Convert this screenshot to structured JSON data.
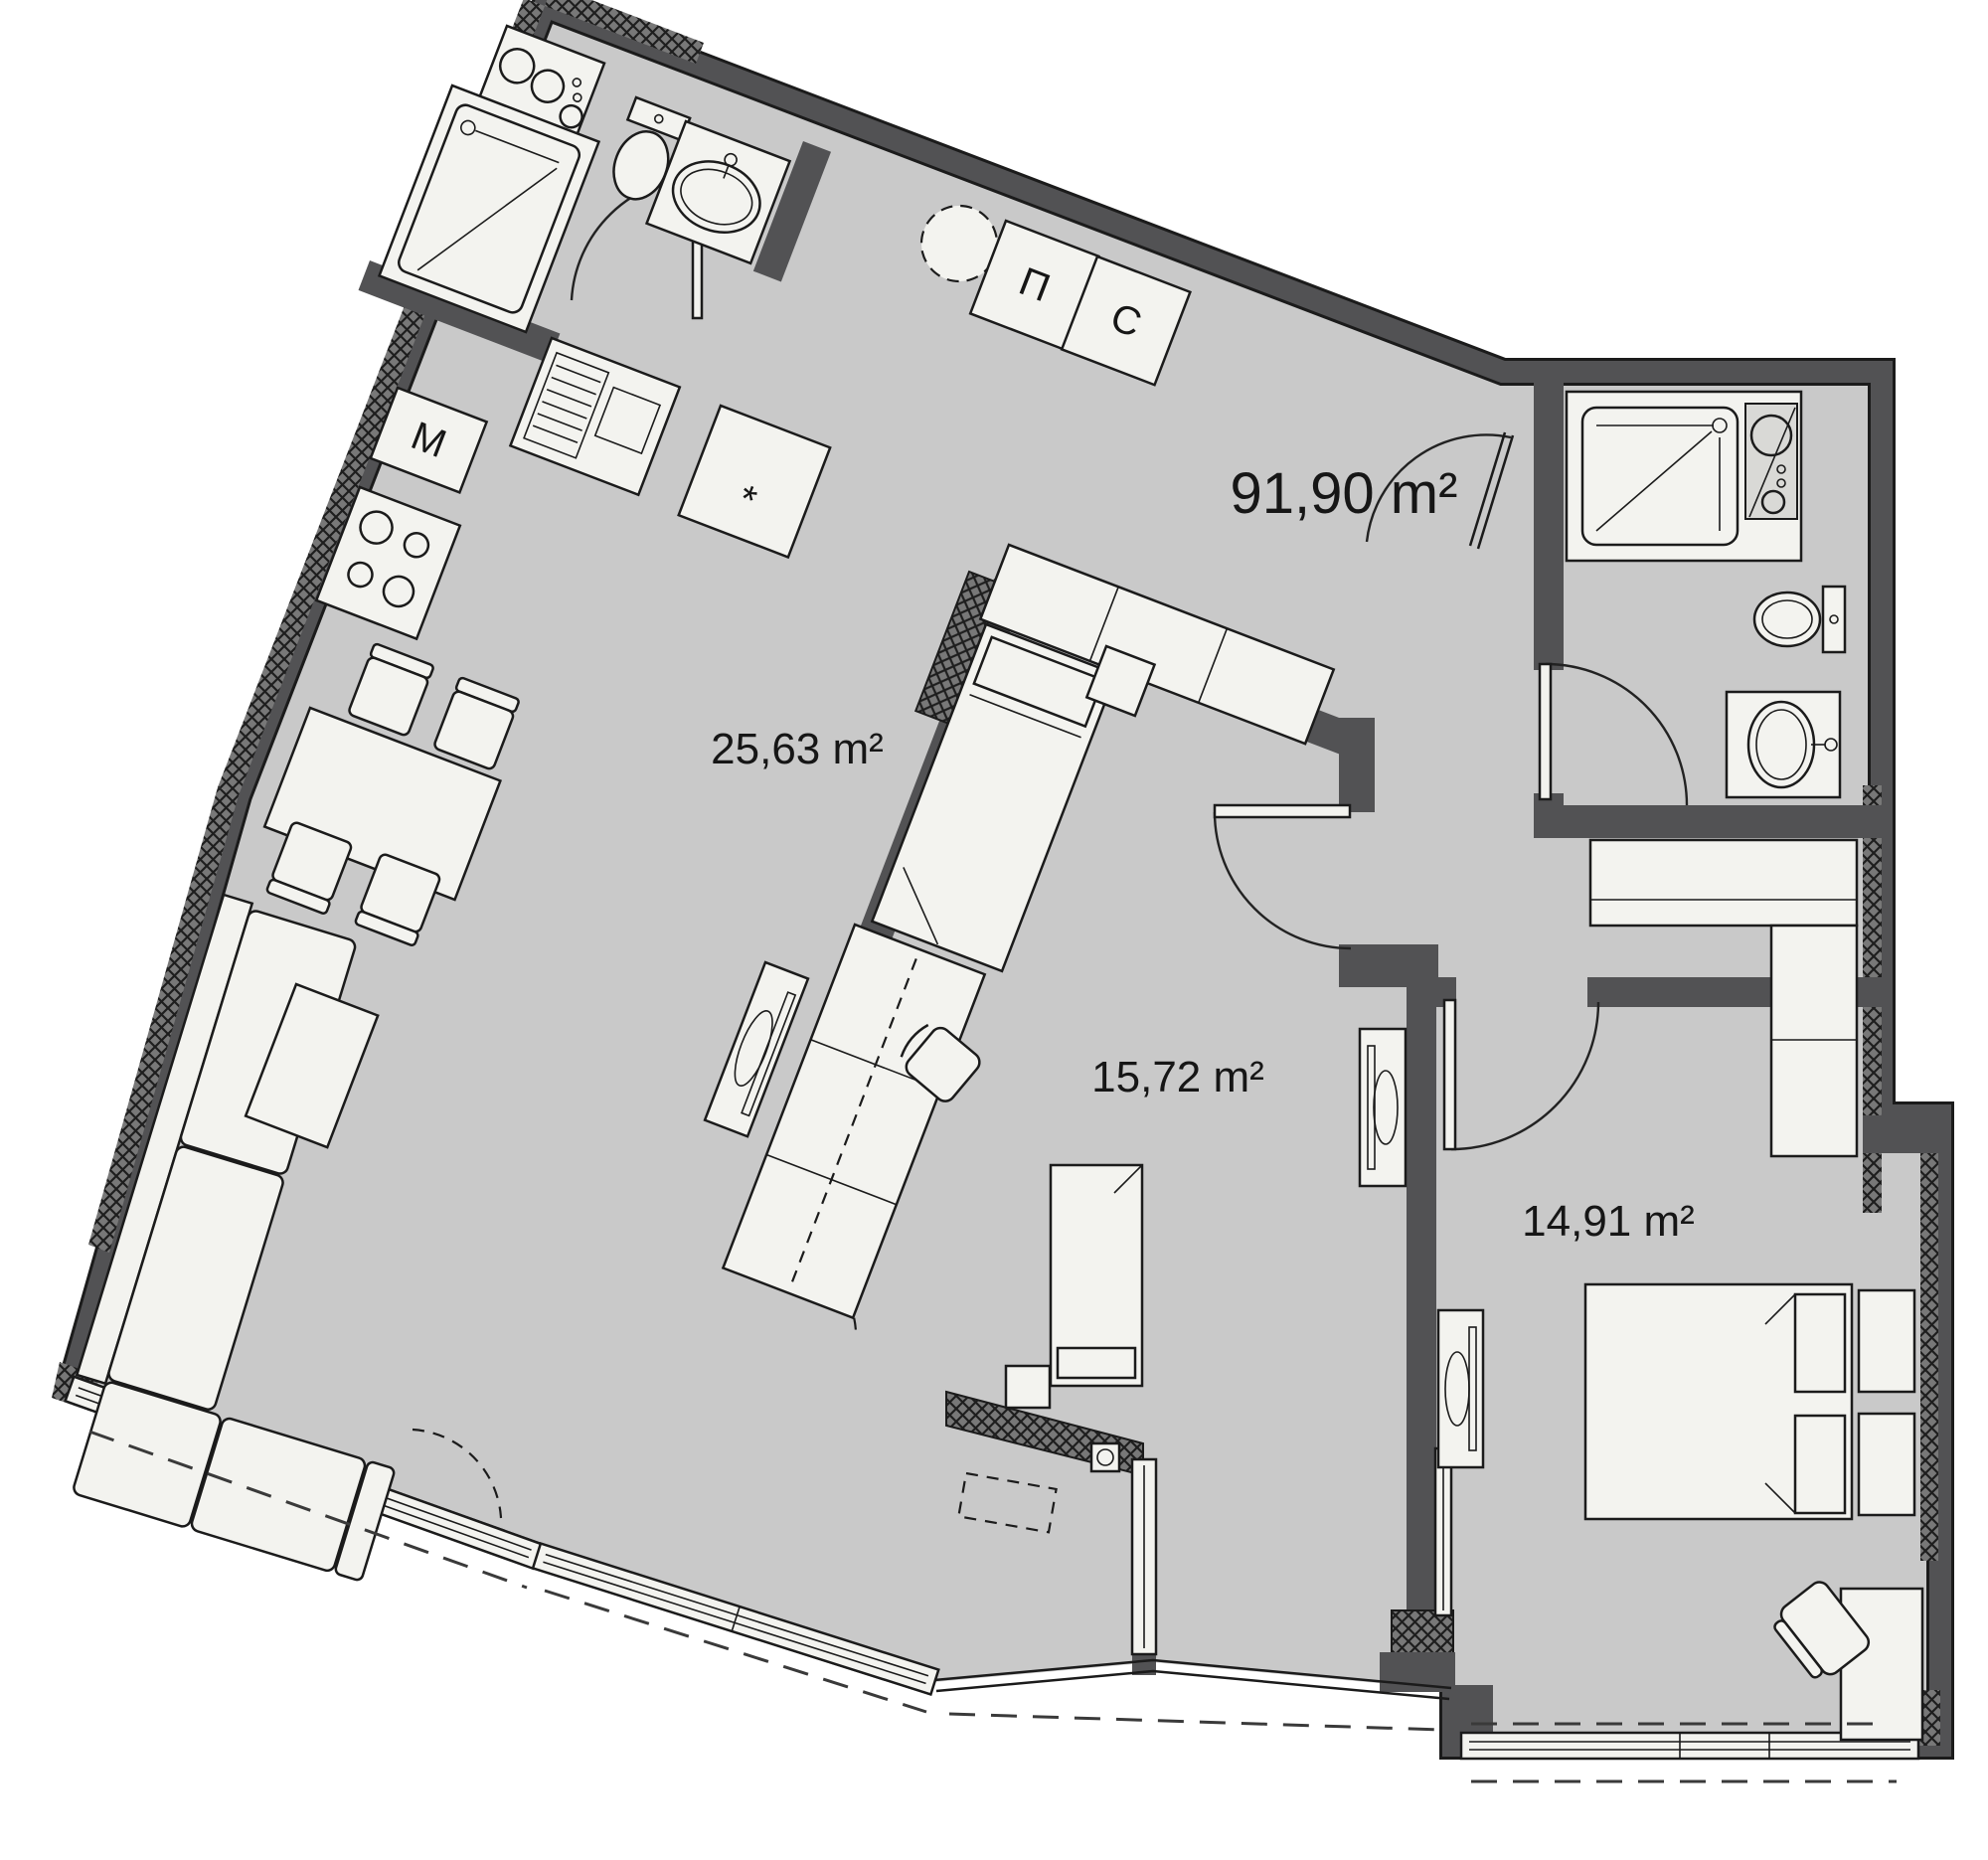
{
  "floor_plan": {
    "kind": "apartment-floor-plan",
    "total_area_label": "91,90 m²",
    "rooms": [
      {
        "id": "living-dining-kitchen",
        "area_label": "25,63 m²"
      },
      {
        "id": "bedroom-children",
        "area_label": "15,72 m²"
      },
      {
        "id": "bedroom-master",
        "area_label": "14,91 m²"
      }
    ],
    "labels": {
      "total": "91,90 m²",
      "living": "25,63 m²",
      "children": "15,72 m²",
      "master": "14,91 m²",
      "washer": "П",
      "dryer": "С",
      "m_cabinet": "М",
      "star": "*"
    },
    "colors": {
      "background": "#ffffff",
      "floor": "#c9c9c9",
      "wall": "#525254",
      "fixture": "#f3f3ef",
      "outline": "#1b1b1b",
      "hatch": "#787878"
    }
  }
}
